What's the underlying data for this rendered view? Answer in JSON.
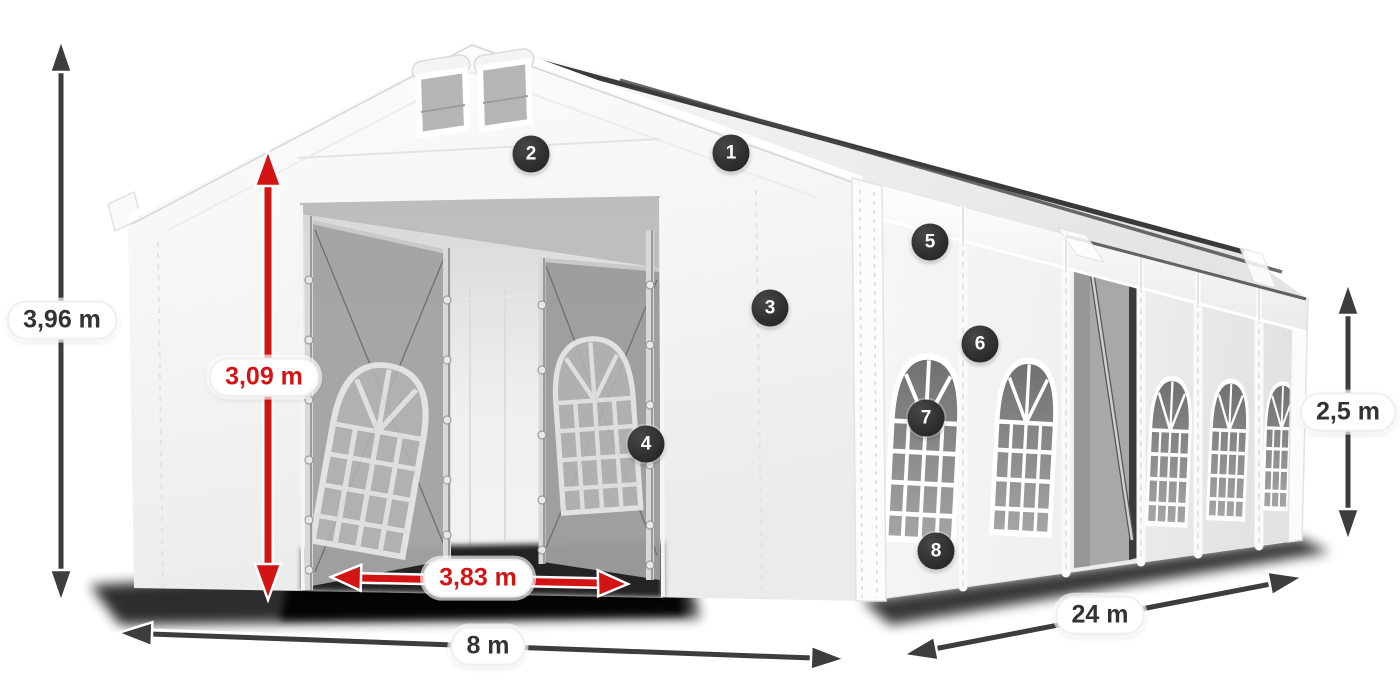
{
  "dimensions": {
    "total_height": {
      "text": "3,96 m"
    },
    "entrance_height": {
      "text": "3,09 m"
    },
    "entrance_width": {
      "text": "3,83 m"
    },
    "width": {
      "text": "8 m"
    },
    "length": {
      "text": "24 m"
    },
    "side_wall_height": {
      "text": "2,5 m"
    }
  },
  "markers": [
    {
      "number": "1"
    },
    {
      "number": "2"
    },
    {
      "number": "3"
    },
    {
      "number": "4"
    },
    {
      "number": "5"
    },
    {
      "number": "6"
    },
    {
      "number": "7"
    },
    {
      "number": "8"
    }
  ],
  "colors": {
    "dimension_red": "#d21414",
    "dimension_black": "#3d3d3d",
    "marker_background": "#2b2b2b",
    "pill_background": "#ffffff",
    "pill_text": "#333333",
    "tent_fabric": "#ffffff"
  }
}
